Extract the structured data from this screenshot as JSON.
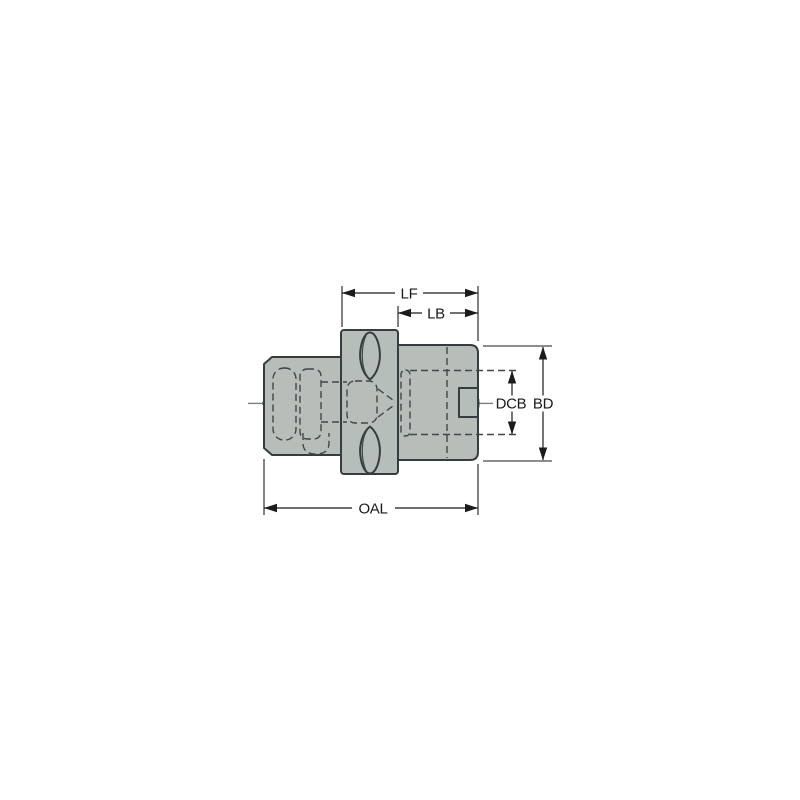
{
  "figure": {
    "dimension_labels": {
      "lf": "LF",
      "lb": "LB",
      "dcb": "DCB",
      "bd": "BD",
      "oal": "OAL"
    },
    "colors": {
      "background": "#ffffff",
      "body_fill": "#b7beba",
      "outline": "#363d40",
      "hidden_line": "#40474a",
      "centerline_band": "#a6acae",
      "centerline_core": "#6d7478",
      "dimension": "#1b1b1b"
    }
  }
}
